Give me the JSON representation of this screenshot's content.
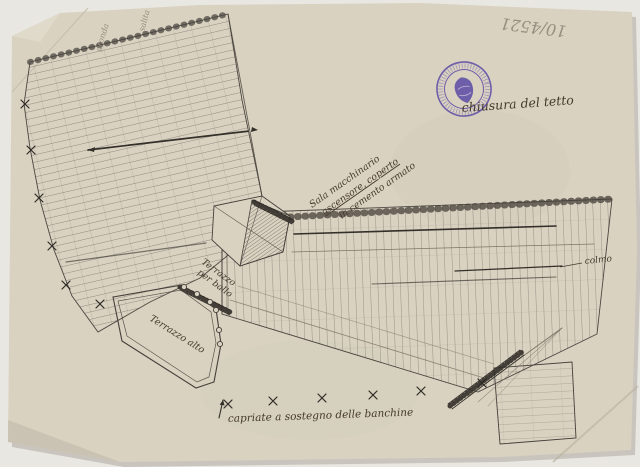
{
  "annotations": {
    "archive_number": "10/4521",
    "edge_note_1": "gronda",
    "edge_note_2": "salita",
    "machine_room": [
      "Sala macchinario",
      "ascensore, coperto",
      "in cemento armato"
    ],
    "roof_note": "chiusura del tetto",
    "ridge_label": "colmo",
    "terrace_ball": [
      "Terrazzo",
      "per ballo"
    ],
    "terrace_high": "Terrazzo alto",
    "truss_caption": "capriate a sostegno delle banchine"
  },
  "stamp": {
    "color": "#5b4aa5",
    "emblem": "shield"
  },
  "colors": {
    "paper": "#d9d2c1",
    "ink": "#3f3a33",
    "pencil": "#8f877a",
    "stamp": "#5b4aa5"
  }
}
